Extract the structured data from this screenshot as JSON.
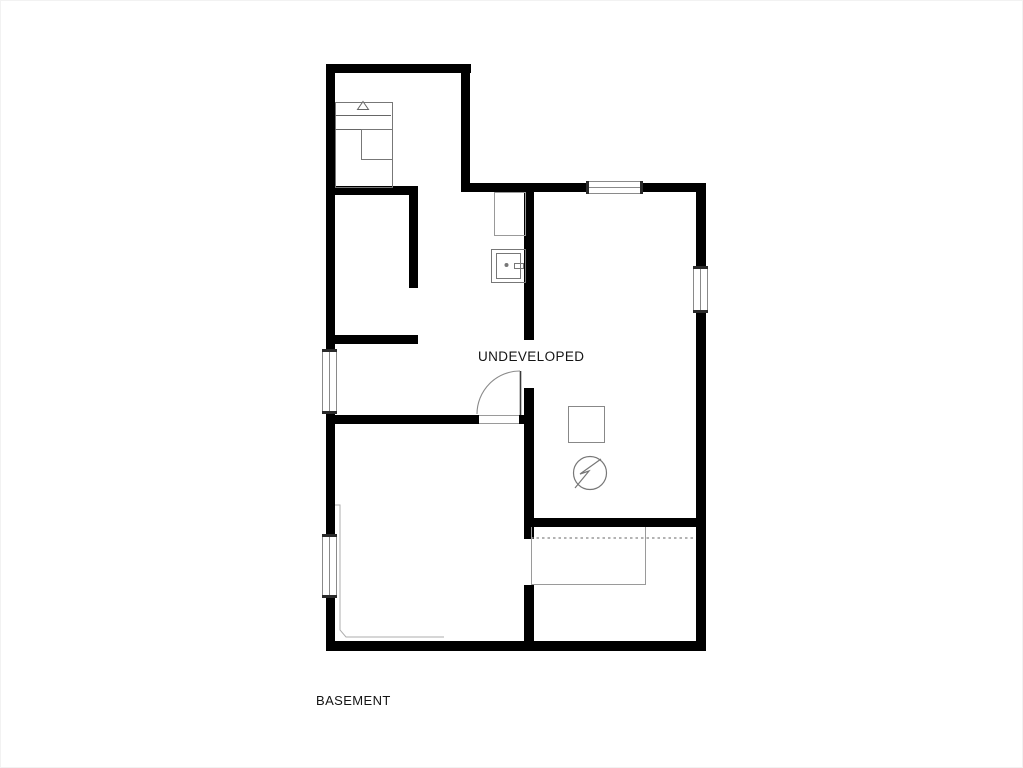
{
  "plan": {
    "title": "basement floor plan",
    "labels": {
      "undeveloped": "UNDEVELOPED",
      "basement": "BASEMENT"
    },
    "colors": {
      "background": "#ffffff",
      "wall": "#000000",
      "fixture_line": "#777777",
      "light_line": "#aaaaaa",
      "stair_line": "#999999",
      "window_frame": "#8a8a8a",
      "window_cap": "#2a2a2a",
      "text": "#141414"
    },
    "icons": {
      "electric_meter": "circle-with-lightning-bolt",
      "furnace_vent": "small-triangle",
      "door_swing": "quarter-arc"
    }
  }
}
